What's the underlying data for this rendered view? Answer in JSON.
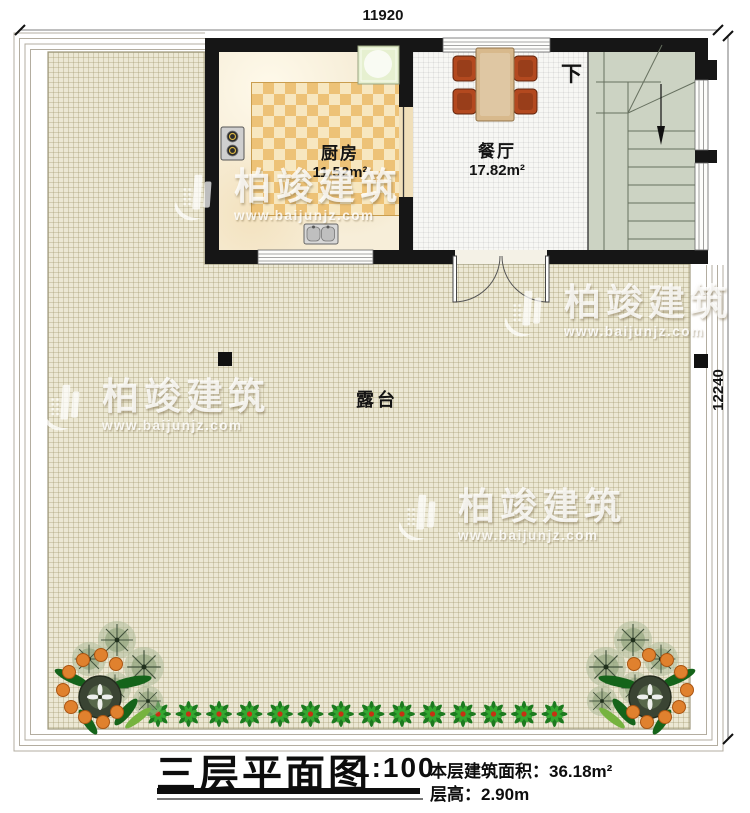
{
  "dimensions": {
    "top_width": "11920",
    "right_height": "12240"
  },
  "rooms": {
    "kitchen": {
      "name": "厨房",
      "area": "11.52m²"
    },
    "dining": {
      "name": "餐厅",
      "area": "17.82m²"
    },
    "terrace": {
      "name": "露台"
    },
    "stairs": {
      "direction_label": "下"
    }
  },
  "watermark": {
    "brand": "柏竣建筑",
    "url": "www.baijunjz.com"
  },
  "title_block": {
    "title": "三层平面图",
    "scale": "1:100",
    "area_label": "本层建筑面积：",
    "area_value": "36.18m²",
    "floor_height_label": "层高：",
    "floor_height_value": "2.90m"
  },
  "colors": {
    "wall": "#161616",
    "terrace_floor": "#ece8d4",
    "kitchen_floor": "#f7eed9",
    "rug_orange": "#edc277",
    "dining_floor": "#f7f7f4",
    "stair_floor": "#ccd3c3",
    "table_wood": "#d8b98c",
    "chair_red": "#b3491f",
    "appliance_green": "#e6f0d0",
    "plant_green": "#1c7a1f",
    "fruit_orange": "#e0812e"
  }
}
